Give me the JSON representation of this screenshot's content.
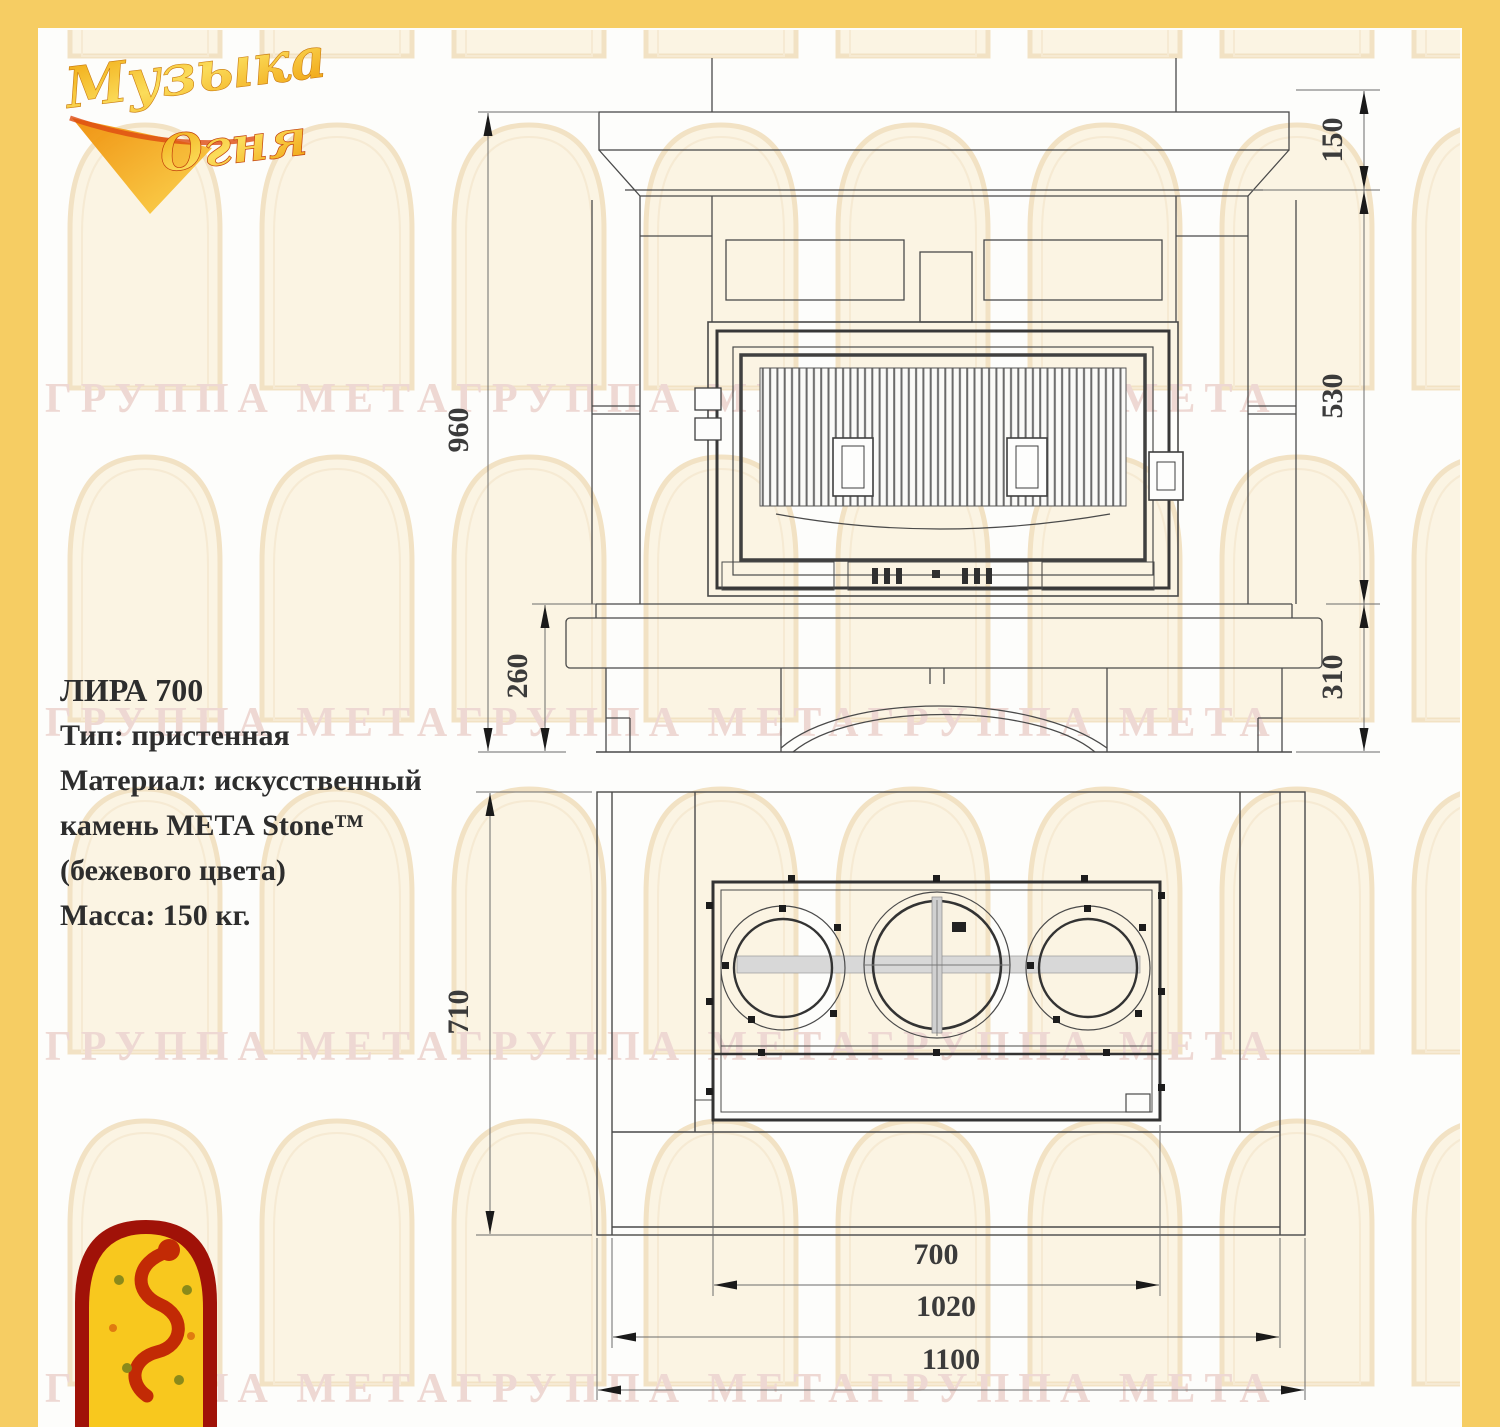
{
  "brand": {
    "name_word1": "Музыка",
    "name_word2": "Огня"
  },
  "info": {
    "title": "ЛИРА 700",
    "line1": "Тип: пристенная",
    "line2": "Материал: искусственный",
    "line3": "камень МЕТА Stone™",
    "line4": "(бежевого цвета)",
    "line5": "Масса: 150 кг."
  },
  "watermark": {
    "text": "ГРУППА МЕТАГРУППА МЕТАГРУППА МЕТА"
  },
  "front_view": {
    "dims": {
      "total_height": "960",
      "mantel_height": "150",
      "firebox_height": "530",
      "base_height_right": "310",
      "base_height_left": "260"
    }
  },
  "plan_view": {
    "dims": {
      "depth": "710",
      "firebox_width": "700",
      "inner_width": "1020",
      "total_width": "1100"
    }
  },
  "colors": {
    "frame": "#f6cd63",
    "watermark": "#eed8d3",
    "line": "#4a4a4a",
    "logo_red": "#b01208",
    "logo_yellow": "#f8c81e"
  }
}
